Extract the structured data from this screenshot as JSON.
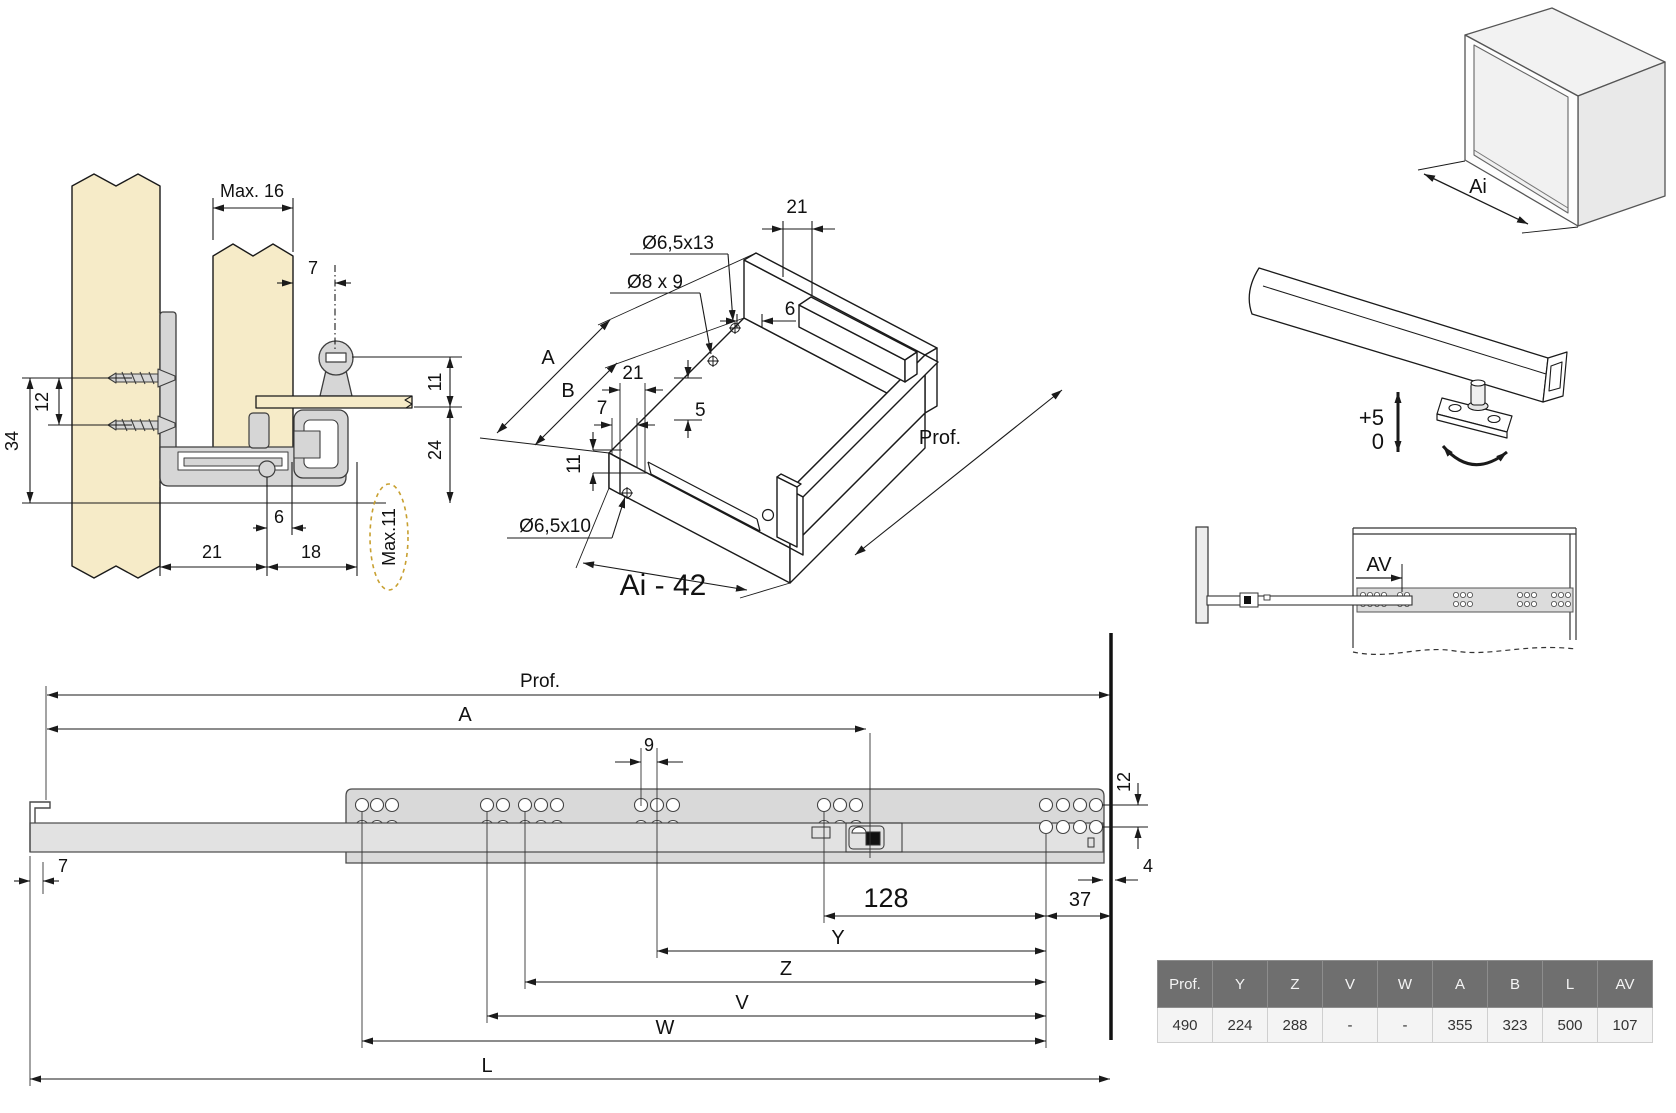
{
  "cross_section": {
    "max16": "Max. 16",
    "d7": "7",
    "d11": "11",
    "d12": "12",
    "d34": "34",
    "d24": "24",
    "d6": "6",
    "d21": "21",
    "d18": "18",
    "max11": "Max.11"
  },
  "isometric": {
    "d21_top": "21",
    "hole_top": "Ø6,5x13",
    "hole_mid": "Ø8 x 9",
    "d6": "6",
    "A": "A",
    "B": "B",
    "d21_mid": "21",
    "d7": "7",
    "d5": "5",
    "d11": "11",
    "hole_front": "Ø6,5x10",
    "prof": "Prof.",
    "title": "Ai - 42"
  },
  "cabinet_box": {
    "ai": "Ai"
  },
  "bracket": {
    "plus": "+5",
    "zero": "0"
  },
  "av_view": {
    "av": "AV"
  },
  "side_view": {
    "prof": "Prof.",
    "A": "A",
    "d9": "9",
    "d12": "12",
    "d7": "7",
    "d4": "4",
    "d128": "128",
    "d37": "37",
    "Y": "Y",
    "Z": "Z",
    "V": "V",
    "W": "W",
    "L": "L"
  },
  "table": {
    "headers": [
      "Prof.",
      "Y",
      "Z",
      "V",
      "W",
      "A",
      "B",
      "L",
      "AV"
    ],
    "values": [
      "490",
      "224",
      "288",
      "-",
      "-",
      "355",
      "323",
      "500",
      "107"
    ]
  },
  "colors": {
    "wood": "#f6ebc8",
    "metal": "#d6d6d6",
    "rail": "#d9d9d9",
    "line": "#1a1a1a",
    "ellipse_dash": "#c8a030",
    "table_header_bg": "#6f6f6f",
    "table_row_bg": "#f4f4f4"
  }
}
